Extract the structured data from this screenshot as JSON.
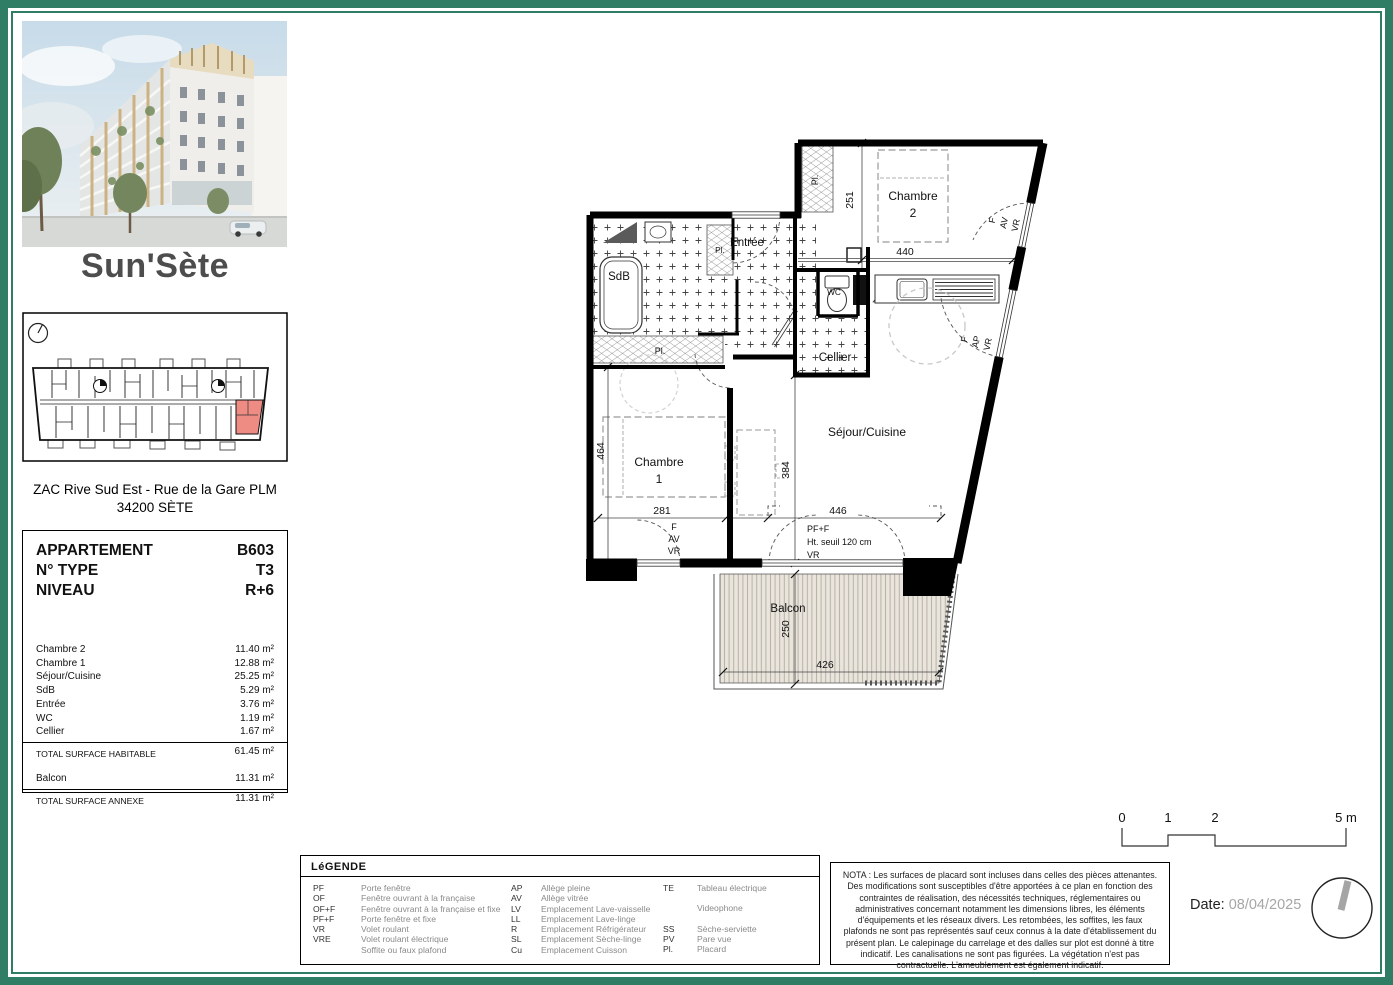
{
  "meta": {
    "title": "Sun'Sète",
    "address_line1": "ZAC Rive Sud Est - Rue de la Gare PLM",
    "address_line2": "34200 SÈTE"
  },
  "apartment": {
    "header": [
      {
        "label": "APPARTEMENT",
        "value": "B603"
      },
      {
        "label": "N° TYPE",
        "value": "T3"
      },
      {
        "label": "NIVEAU",
        "value": "R+6"
      }
    ],
    "rooms": [
      {
        "label": "Chambre 2",
        "value": "11.40 m²"
      },
      {
        "label": "Chambre 1",
        "value": "12.88 m²"
      },
      {
        "label": "Séjour/Cuisine",
        "value": "25.25 m²"
      },
      {
        "label": "SdB",
        "value": "5.29 m²"
      },
      {
        "label": "Entrée",
        "value": "3.76 m²"
      },
      {
        "label": "WC",
        "value": "1.19 m²"
      },
      {
        "label": "Cellier",
        "value": "1.67 m²"
      }
    ],
    "total_hab": {
      "label": "TOTAL SURFACE HABITABLE",
      "value": "61.45 m²"
    },
    "balcon": {
      "label": "Balcon",
      "value": "11.31 m²"
    },
    "total_annexe": {
      "label": "TOTAL SURFACE ANNEXE",
      "value": "11.31 m²"
    }
  },
  "plan": {
    "rooms": {
      "chambre2a": "Chambre",
      "chambre2b": "2",
      "chambre1a": "Chambre",
      "chambre1b": "1",
      "sejour": "Séjour/Cuisine",
      "sdb": "SdB",
      "entree": "Entrée",
      "wc": "WC",
      "cellier": "Cellier",
      "balcon": "Balcon",
      "placard": "Pl."
    },
    "dims": {
      "d251": "251",
      "d440": "440",
      "d464": "464",
      "d281": "281",
      "d384": "384",
      "d446": "446",
      "d250": "250",
      "d426": "426"
    },
    "windows": {
      "f": "F",
      "av": "AV",
      "ap": "AP",
      "vr": "VR",
      "pff": "PF+F",
      "seuil": "Ht. seuil 120 cm"
    }
  },
  "legend": {
    "title": "LéGENDE",
    "col1": [
      {
        "a": "PF",
        "t": "Porte fenêtre"
      },
      {
        "a": "OF",
        "t": "Fenêtre ouvrant à la française"
      },
      {
        "a": "OF+F",
        "t": "Fenêtre ouvrant à la française et fixe"
      },
      {
        "a": "PF+F",
        "t": "Porte fenêtre et fixe"
      },
      {
        "a": "VR",
        "t": "Volet roulant"
      },
      {
        "a": "VRE",
        "t": "Volet roulant électrique"
      },
      {
        "a": "",
        "t": "Soffite ou faux plafond"
      }
    ],
    "col2": [
      {
        "a": "AP",
        "t": "Allège pleine"
      },
      {
        "a": "AV",
        "t": "Allège vitrée"
      },
      {
        "a": "LV",
        "t": "Emplacement Lave-vaisselle"
      },
      {
        "a": "LL",
        "t": "Emplacement Lave-linge"
      },
      {
        "a": "R",
        "t": "Emplacement Réfrigérateur"
      },
      {
        "a": "SL",
        "t": "Emplacement Sèche-linge"
      },
      {
        "a": "Cu",
        "t": "Emplacement Cuisson"
      }
    ],
    "col3": [
      {
        "a": "TE",
        "t": "Tableau électrique"
      },
      {
        "a": "",
        "t": "Videophone"
      },
      {
        "a": "SS",
        "t": "Sèche-serviette"
      },
      {
        "a": "PV",
        "t": "Pare vue"
      },
      {
        "a": "Pl.",
        "t": "Placard"
      }
    ]
  },
  "nota": "NOTA : Les surfaces de placard sont incluses dans celles des pièces attenantes. Des modifications sont susceptibles d'être apportées à ce plan en fonction des contraintes de réalisation, des nécessités techniques, réglementaires ou administratives concernant notamment les dimensions libres, les éléments d'équipements et les réseaux divers. Les retombées, les soffites, les faux plafonds ne sont pas représentés sauf ceux connus à la date d'établissement du présent plan. Le calepinage du carrelage et des dalles sur plot est donné à titre indicatif. Les canalisations ne sont pas figurées. La végétation n'est pas contractuelle. L'ameublement est également indicatif.",
  "scalebar": {
    "labels": [
      "0",
      "1",
      "2",
      "5 m"
    ]
  },
  "footer": {
    "date_label": "Date:",
    "date_value": "08/04/2025"
  }
}
